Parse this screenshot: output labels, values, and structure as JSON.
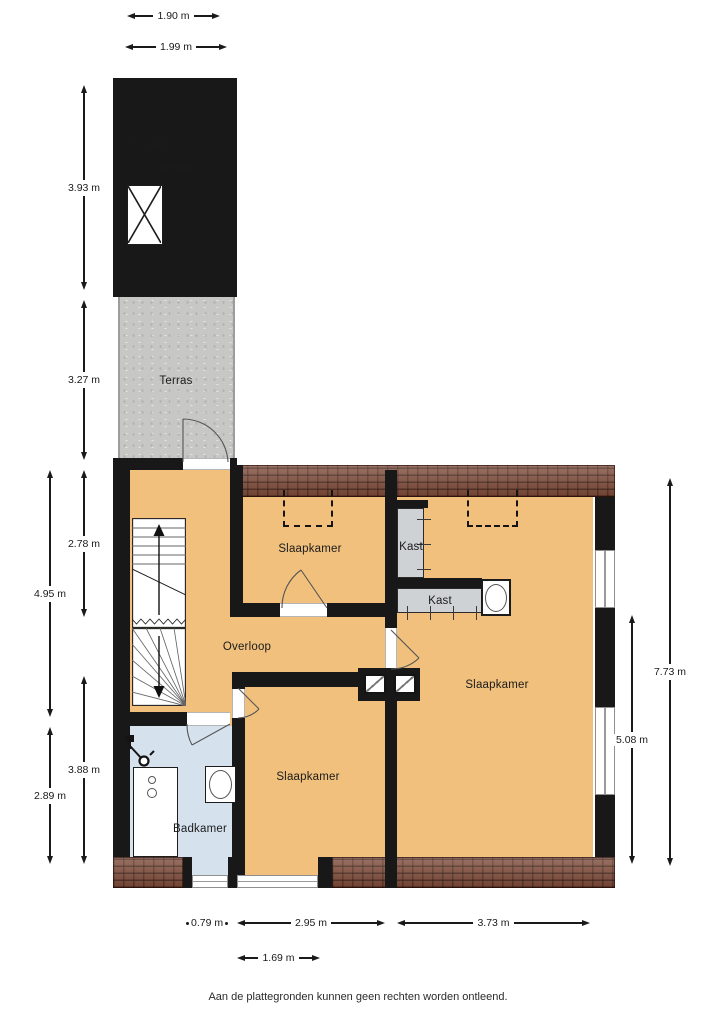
{
  "rooms": {
    "vliering": {
      "label": "Vliering",
      "height_note": "H = 2.42m"
    },
    "terras": {
      "label": "Terras"
    },
    "slaapkamer_top": {
      "label": "Slaapkamer"
    },
    "slaapkamer_right": {
      "label": "Slaapkamer"
    },
    "slaapkamer_bottom": {
      "label": "Slaapkamer"
    },
    "overloop": {
      "label": "Overloop"
    },
    "badkamer": {
      "label": "Badkamer"
    },
    "kast_vertical": {
      "label": "Kast"
    },
    "kast_horizontal": {
      "label": "Kast"
    }
  },
  "dimensions": {
    "top": [
      "1.90 m",
      "1.99 m"
    ],
    "left": [
      "3.93 m",
      "3.27 m",
      "2.78 m",
      "4.95 m",
      "3.88 m",
      "2.89 m"
    ],
    "right": [
      "7.73 m",
      "5.08 m"
    ],
    "bottom": [
      "0.79 m",
      "2.95 m",
      "3.73 m",
      "1.69 m"
    ]
  },
  "disclaimer": "Aan de plattegronden kunnen geen rechten worden ontleend.",
  "colors": {
    "wall": "#181818",
    "floor": "#f0c07c",
    "bath": "#d5e2ee",
    "terrace": "#c7c7c5",
    "attic": "#dcdcdc",
    "closet": "#ced2d5",
    "roof": "#7e4a38"
  }
}
